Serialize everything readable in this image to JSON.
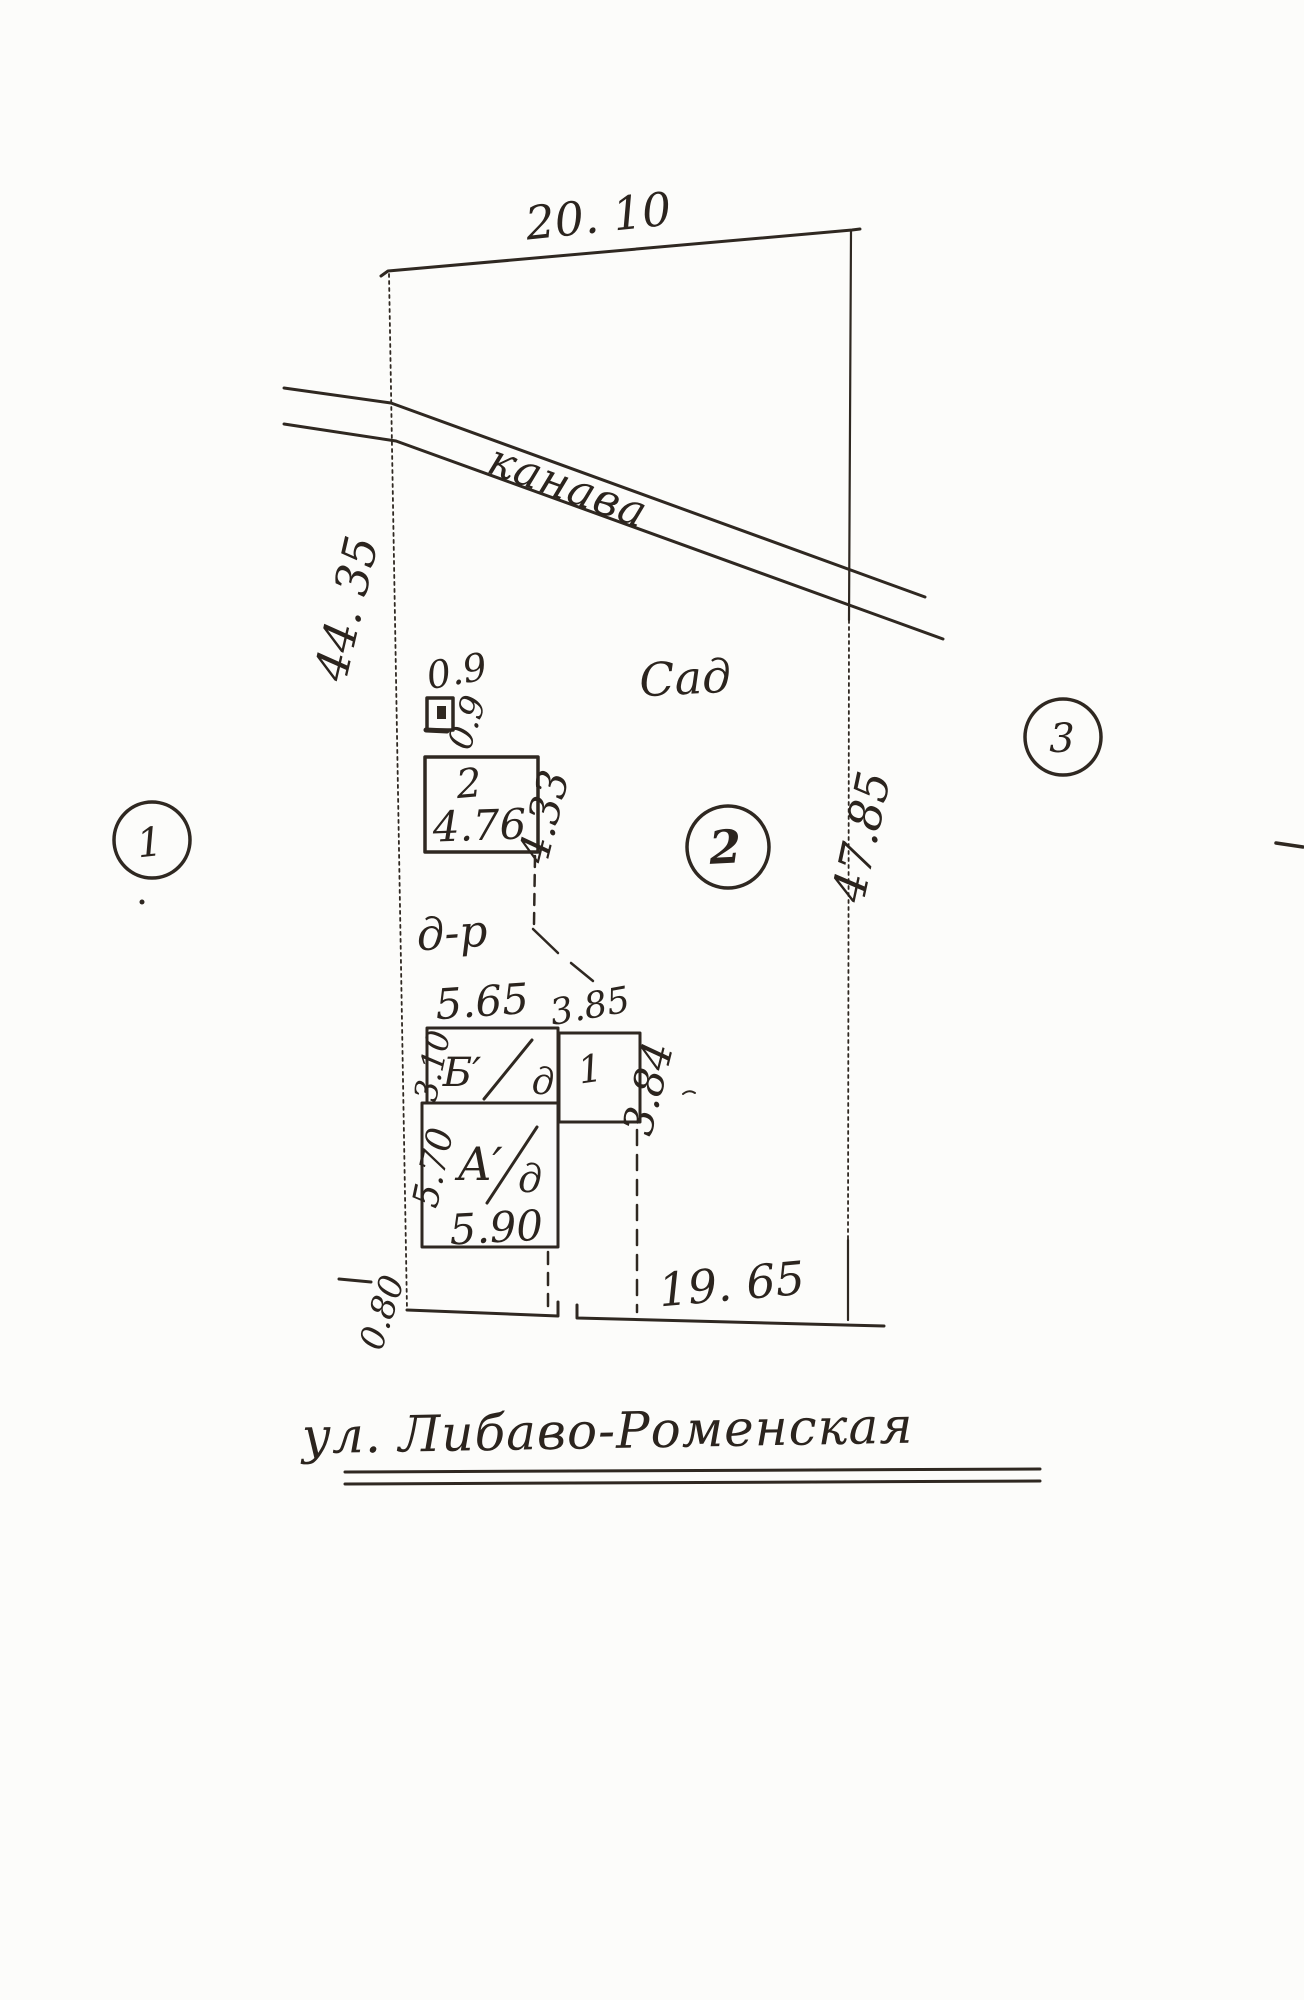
{
  "plan": {
    "dimensions": {
      "top_width": "20. 10",
      "left_side": "44. 35",
      "right_side": "47.85",
      "bottom_width": "19. 65",
      "bottom_offset": "0.80"
    },
    "features": {
      "ditch": "канава",
      "garden": "Сад",
      "footpath": "д-р",
      "street": "ул. Либаво-Роменская"
    },
    "well": {
      "label_top": "0.9",
      "label_side": "0.9"
    },
    "parcel_markers": {
      "left": "1",
      "middle": "2",
      "right": "3"
    },
    "buildings": {
      "shed": {
        "number": "2",
        "width": "4.76",
        "depth": "4.33"
      },
      "annex_b": {
        "letter": "Б′",
        "material": "д",
        "width_top": "5.65",
        "depth_left": "3.10"
      },
      "porch": {
        "number": "1",
        "width_top": "3.85",
        "depth_right": "3.84"
      },
      "house_a": {
        "letter": "А′",
        "material": "д",
        "depth_left": "5.70",
        "width_bottom": "5.90"
      }
    }
  }
}
